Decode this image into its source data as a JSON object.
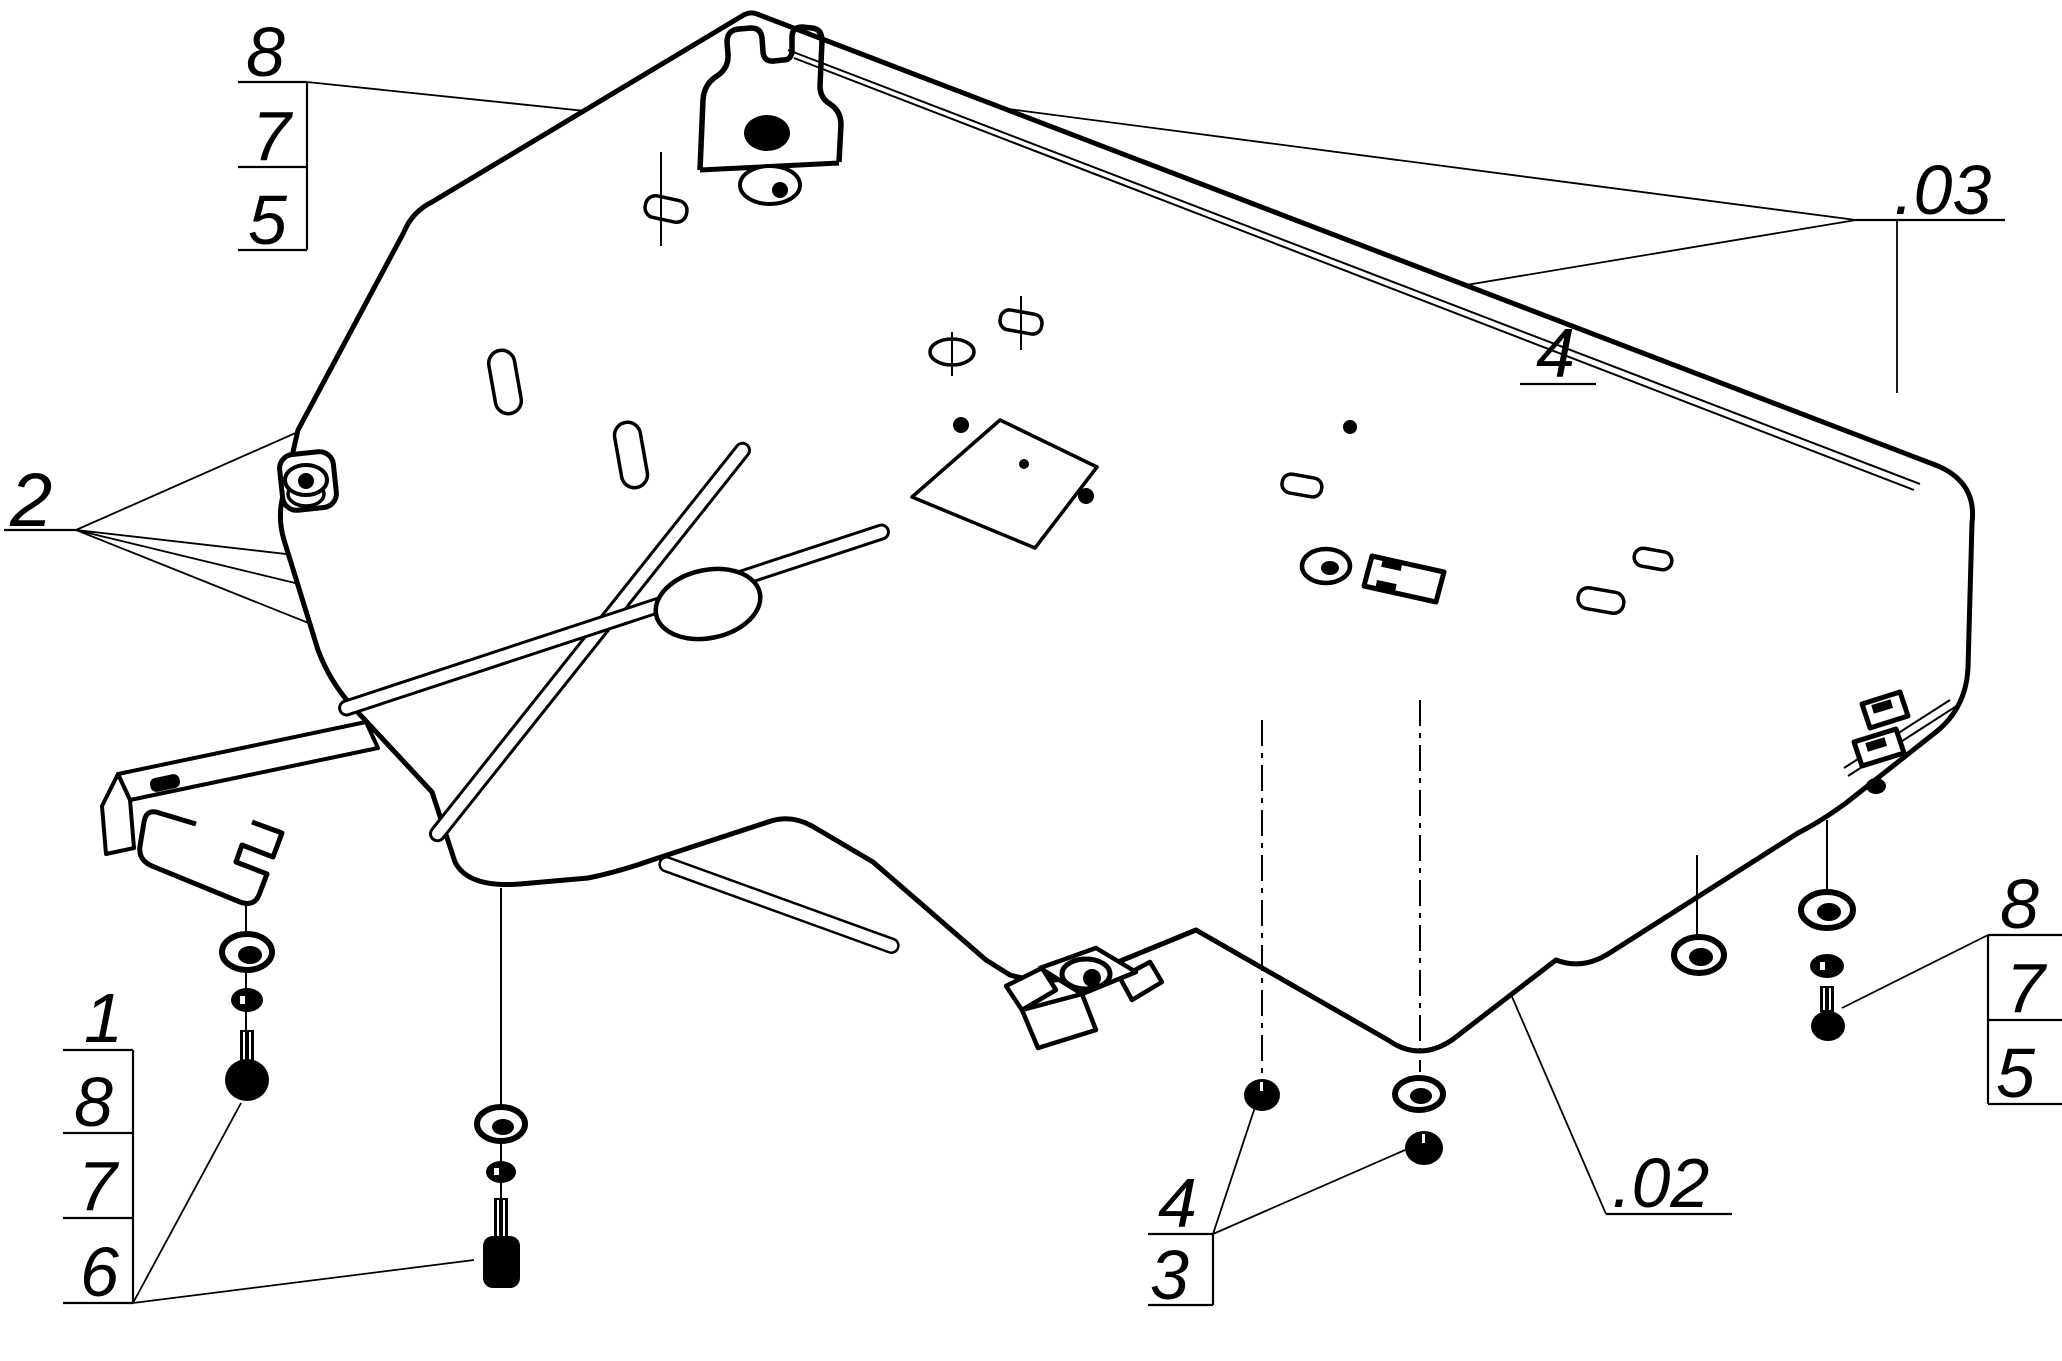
{
  "drawing": {
    "kind": "exploded-assembly-line-drawing",
    "colors": {
      "background": "#ffffff",
      "ink": "#000000"
    },
    "callouts": {
      "top_left_stack": {
        "items": [
          "8",
          "7",
          "5"
        ]
      },
      "left_label": {
        "text": "2"
      },
      "plate_holes_label": {
        "text": "4"
      },
      "subassembly_03": {
        "text": ".03"
      },
      "subassembly_02": {
        "text": ".02"
      },
      "bottom_left_stack": {
        "items": [
          "1",
          "8",
          "7",
          "6"
        ]
      },
      "bottom_center_stack": {
        "items": [
          "4",
          "3"
        ]
      },
      "right_stack": {
        "items": [
          "8",
          "7",
          "5"
        ]
      }
    }
  }
}
